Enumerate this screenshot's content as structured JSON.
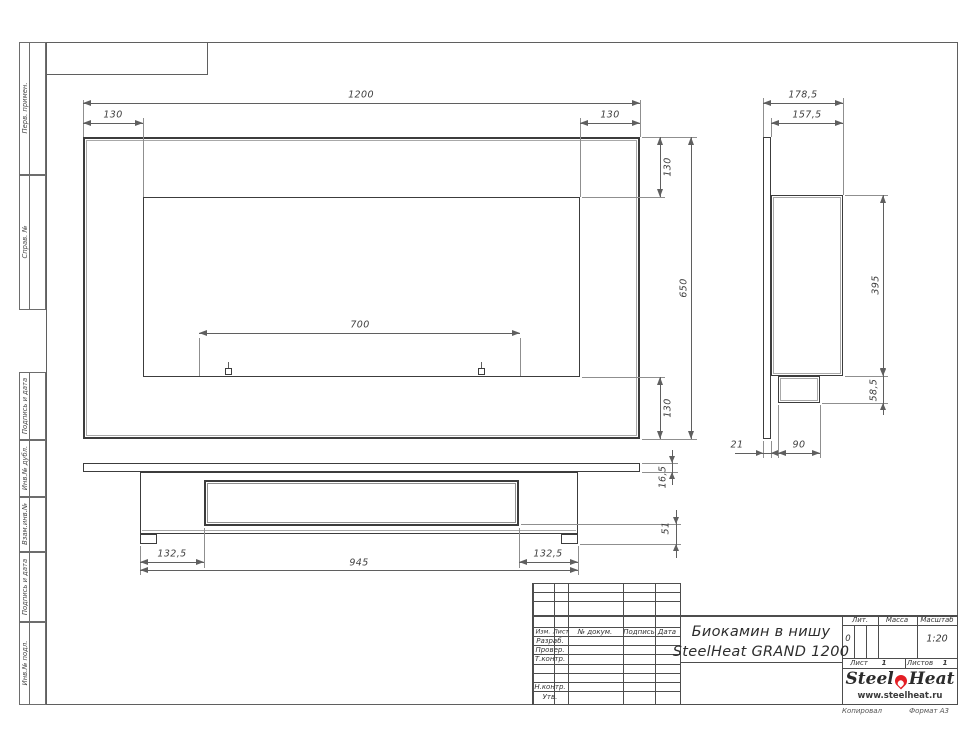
{
  "margin_labels": [
    "Перв. примен.",
    "Справ. №",
    "Подпись и дата",
    "Инв.№ дубл.",
    "Взам.инв.№",
    "Подпись и дата",
    "Инв.№ подл."
  ],
  "views": {
    "front": {
      "dims": {
        "total_width": "1200",
        "left_offset": "130",
        "right_offset": "130",
        "top_offset": "130",
        "total_height": "650",
        "bottom_offset": "130",
        "mount_spacing": "700"
      }
    },
    "side": {
      "dims": {
        "total_depth": "178,5",
        "body_depth": "157,5",
        "body_height": "395",
        "burner_height": "58,5",
        "panel_thickness": "21",
        "burner_depth": "90"
      }
    },
    "bottom": {
      "dims": {
        "left_margin": "132,5",
        "body_width": "945",
        "right_margin": "132,5",
        "panel_thickness": "16,5",
        "depth": "51"
      }
    }
  },
  "title_block": {
    "columns": [
      "Изм.",
      "Лист",
      "№ докум.",
      "Подпись",
      "Дата"
    ],
    "rows": [
      "Разраб.",
      "Провер.",
      "Т.контр.",
      "Н.контр.",
      "Утв."
    ],
    "title_line1": "Биокамин в нишу",
    "title_line2": "SteelHeat GRAND 1200",
    "lit_label": "Лит.",
    "lit_value": "0",
    "massa_label": "Масса",
    "massa_value": "",
    "scale_label": "Масштаб",
    "scale_value": "1:20",
    "sheet_label": "Лист",
    "sheet_value": "1",
    "sheets_label": "Листов",
    "sheets_value": "1",
    "logo": {
      "part1": "Steel",
      "part2": "Heat",
      "url": "www.steelheat.ru",
      "flame_color": "#e31e24"
    },
    "footer_left": "Копировал",
    "footer_right": "Формат А3"
  }
}
